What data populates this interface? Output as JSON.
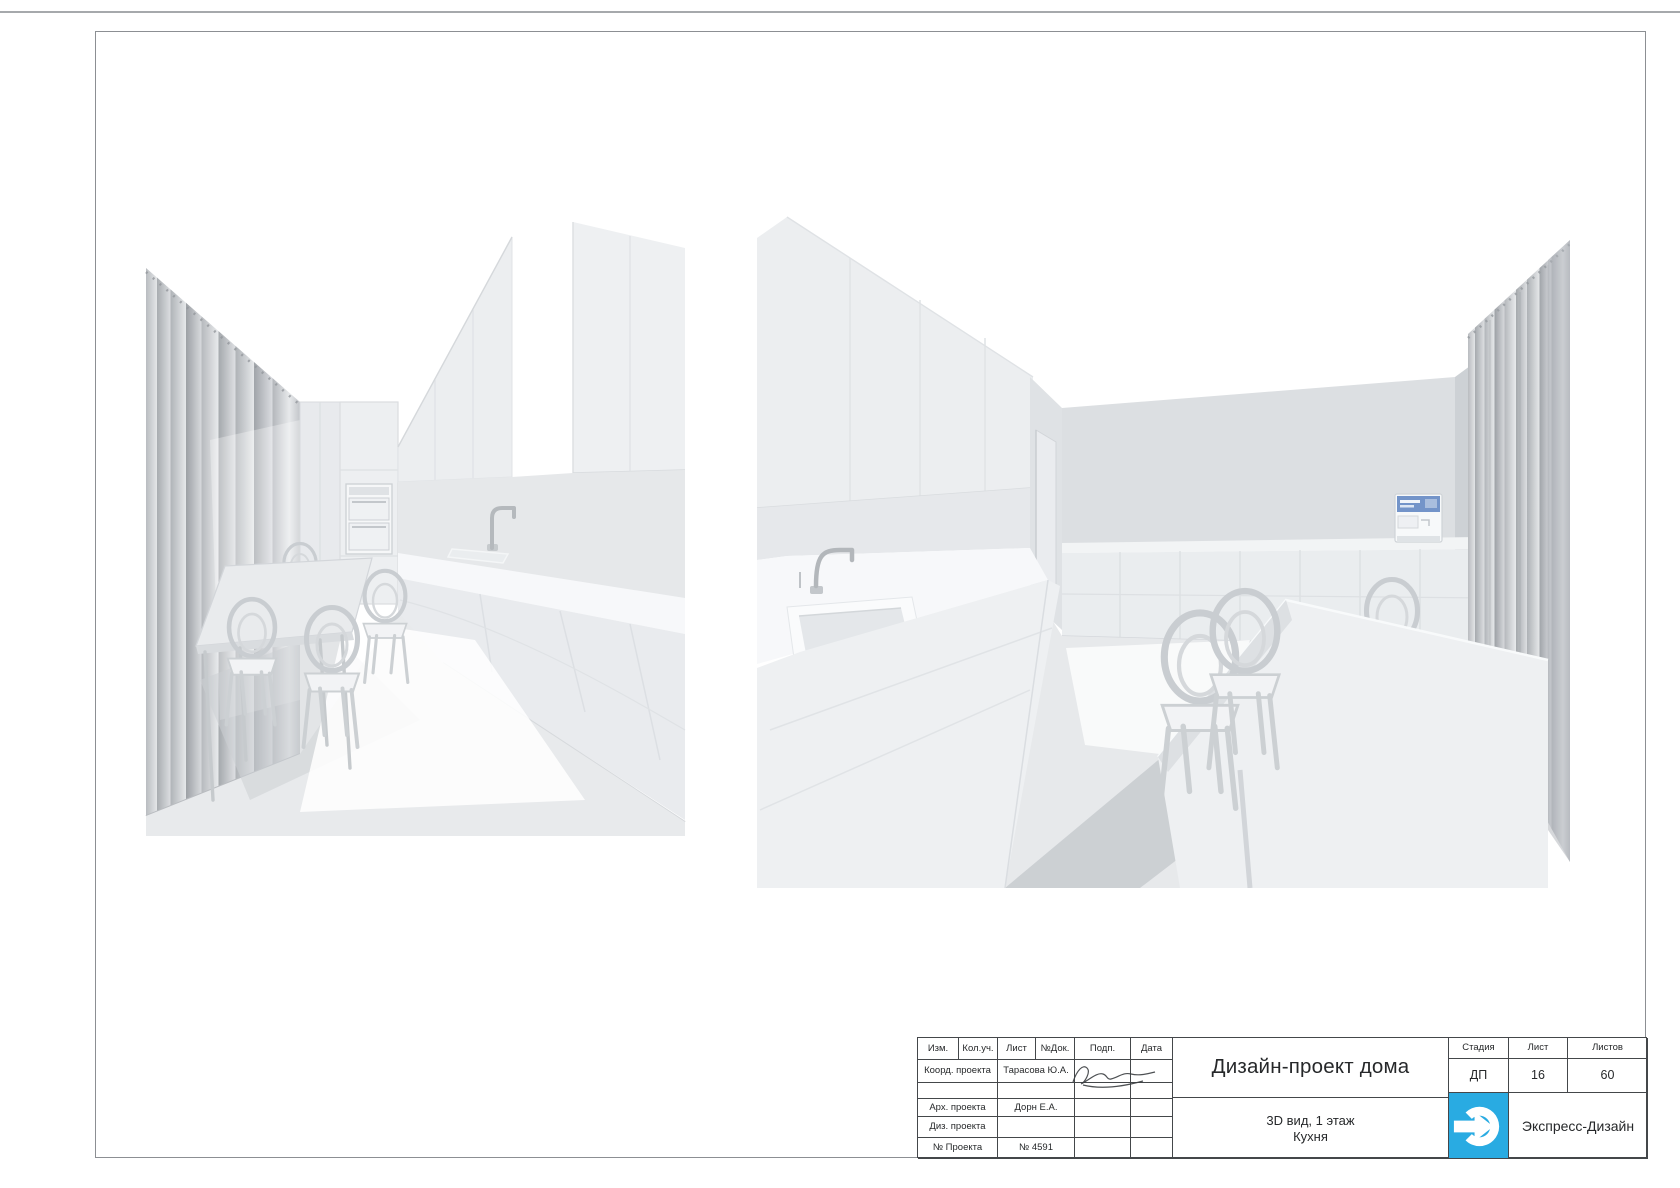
{
  "page": {
    "colors": {
      "logo_blue": "#29ABE2",
      "table_line": "#44474a",
      "frame": "#8c8f93",
      "top_rule": "#a6a9ac"
    }
  },
  "renders": {
    "left_alt": "3D clay render — kitchen view 1: dining table with chairs, curtains on left, oven column and cabinet run on right",
    "right_alt": "3D clay render — kitchen view 2: sink and cabinets on left, doorway, coffee machine, dining table and curtained window on right"
  },
  "title_block": {
    "revision_header": {
      "izm": "Изм.",
      "koluch": "Кол.уч.",
      "list": "Лист",
      "ndok": "№Док.",
      "podp": "Подп.",
      "data": "Дата"
    },
    "rows": [
      {
        "role": "Коорд. проекта",
        "name": "Тарасова Ю.А."
      },
      {
        "role": "",
        "name": ""
      },
      {
        "role": "Арх. проекта",
        "name": "Дорн Е.А."
      },
      {
        "role": "Диз. проекта",
        "name": ""
      },
      {
        "role": "№ Проекта",
        "name": "№ 4591"
      }
    ],
    "project_title": "Дизайн-проект дома",
    "sheet_title_line1": "3D вид, 1 этаж",
    "sheet_title_line2": "Кухня",
    "stage_label": "Стадия",
    "sheet_label": "Лист",
    "sheets_label": "Листов",
    "stage_value": "ДП",
    "sheet_value": "16",
    "sheets_value": "60",
    "company": "Экспресс-Дизайн",
    "logo_color": "#29ABE2"
  }
}
